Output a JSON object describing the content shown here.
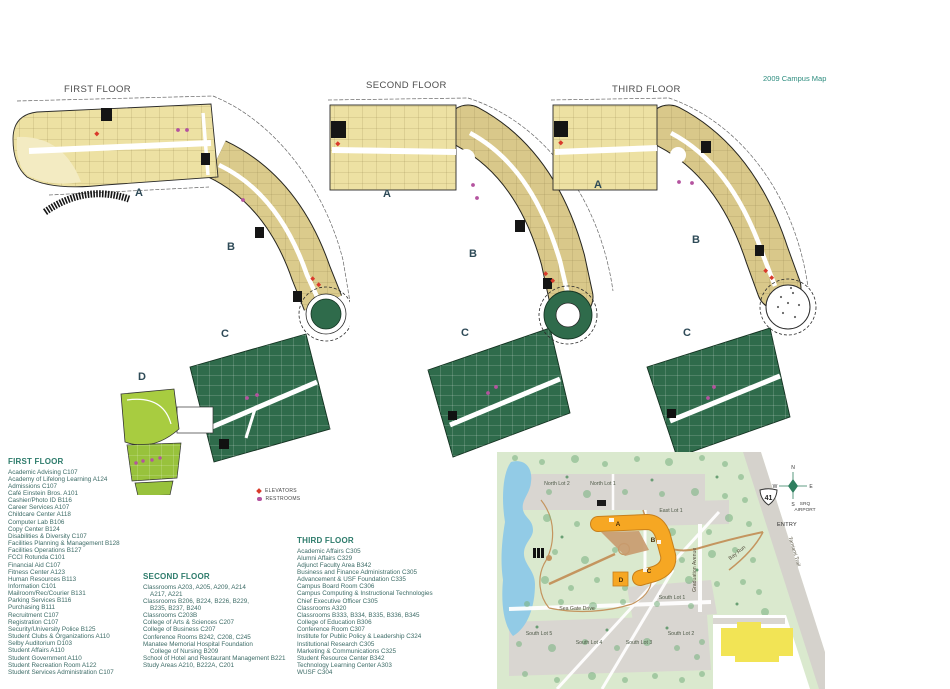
{
  "header": {
    "map_title": "2009 Campus Map"
  },
  "floors": {
    "first": {
      "title": "FIRST FLOOR",
      "wings": [
        "A",
        "B",
        "C",
        "D"
      ]
    },
    "second": {
      "title": "SECOND FLOOR",
      "wings": [
        "A",
        "B",
        "C"
      ]
    },
    "third": {
      "title": "THIRD FLOOR",
      "wings": [
        "A",
        "B",
        "C"
      ]
    }
  },
  "key": {
    "elevators": "ELEVATORS",
    "restrooms": "RESTROOMS"
  },
  "legend": {
    "first": {
      "heading": "FIRST FLOOR",
      "items": [
        "Academic Advising C107",
        "Academy of Lifelong Learning A124",
        "Admissions C107",
        "Café Einstein Bros. A101",
        "Cashier/Photo ID B116",
        "Career Services A107",
        "Childcare Center A118",
        "Computer Lab B106",
        "Copy Center B124",
        "Disabilities & Diversity C107",
        "Facilities Planning & Management B128",
        "Facilities Operations B127",
        "FCCI Rotunda C101",
        "Financial Aid C107",
        "Fitness Center A123",
        "Human Resources B113",
        "Information C101",
        "Mailroom/Rec/Courier B131",
        "Parking Services B116",
        "Purchasing B111",
        "Recruitment C107",
        "Registration C107",
        "Security/University Police B125",
        "Student Clubs & Organizations A110",
        "Selby Auditorium D103",
        "Student Affairs A110",
        "Student Government A110",
        "Student Recreation Room A122",
        "Student Services Administration C107"
      ]
    },
    "second": {
      "heading": "SECOND FLOOR",
      "items": [
        "Classrooms A203, A205, A209, A214\nA217, A221",
        "Classrooms B206, B224, B226, B229,\nB235, B237, B240",
        "Classrooms C203B",
        "College of Arts & Sciences C207",
        "College of Business C207",
        "Conference Rooms B242, C208, C245",
        "Manatee Memorial Hospital Foundation\nCollege of Nursing B209",
        "School of Hotel and Restaurant Management B221",
        "Study Areas A210, B222A, C201"
      ]
    },
    "third": {
      "heading": "THIRD FLOOR",
      "items": [
        "Academic Affairs C305",
        "Alumni Affairs C329",
        "Adjunct Faculty Area B342",
        "Business and Finance Administration C305",
        "Advancement & USF Foundation C335",
        "Campus Board Room C306",
        "Campus Computing & Instructional Technologies",
        "Chief Executive Officer C305",
        "Classrooms A320",
        "Classrooms B333, B334, B335, B336, B345",
        "College of Education B306",
        "Conference Room C307",
        "Institute for Public Policy & Leadership C324",
        "Institutional Research C305",
        "Marketing & Communications C325",
        "Student Resource Center B342",
        "Technology Learning Center A303",
        "WUSF C304"
      ]
    }
  },
  "site_map": {
    "lots": {
      "north2": "North Lot 2",
      "north1": "North Lot 1",
      "east1": "East Lot 1",
      "south1": "South Lot 1",
      "south2": "South Lot 2",
      "south3": "South Lot 3",
      "south4": "South Lot 4",
      "south5": "South Lot 5"
    },
    "roads": {
      "sea_gate": "Sea Gate Drive",
      "graduation": "Graduation Avenue",
      "bay_run": "Bay Run",
      "tamiami": "Tamiami Trail",
      "entry": "ENTRY",
      "route_number": "41",
      "airport_line1": "SRQ",
      "airport_line2": "AIRPORT"
    },
    "compass": {
      "n": "N",
      "e": "E",
      "s": "S",
      "w": "W"
    },
    "wings": [
      "A",
      "B",
      "C",
      "D"
    ]
  },
  "colors": {
    "wing_a_fill": "#EDE1A3",
    "wing_b_fill": "#DBCB8C",
    "wing_c_fill": "#2F6B4B",
    "auditorium_green": "#A8CC40",
    "site_green": "#DAE9CE",
    "lake_blue": "#92CBE6",
    "lot_gray": "#D9D6D1",
    "building_orange": "#F6A723",
    "elevator_red": "#D93A2B",
    "restroom_purple": "#B4539F",
    "accent_teal": "#2C8C7E"
  }
}
